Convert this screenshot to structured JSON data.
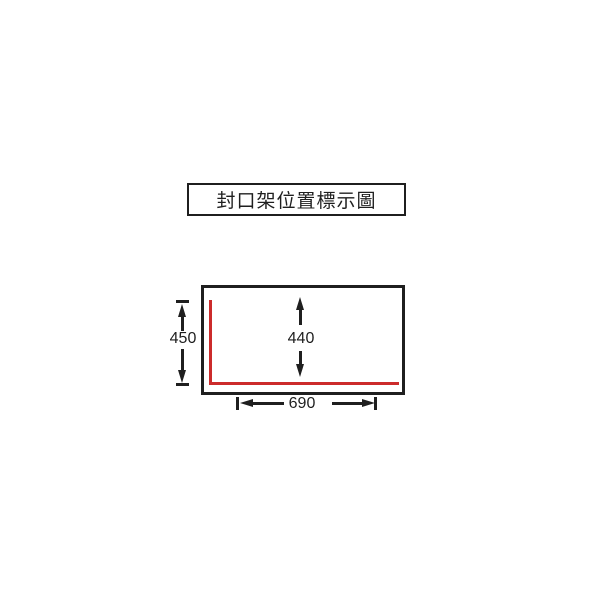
{
  "title": {
    "text": "封口架位置標示圖"
  },
  "dimensions": {
    "left_height": {
      "value": "450"
    },
    "inner_height": {
      "value": "440"
    },
    "bottom_width": {
      "value": "690"
    }
  },
  "colors": {
    "line_ink": "#1f1f1f",
    "seal_frame_red": "#cc2b2b",
    "background": "#ffffff"
  }
}
